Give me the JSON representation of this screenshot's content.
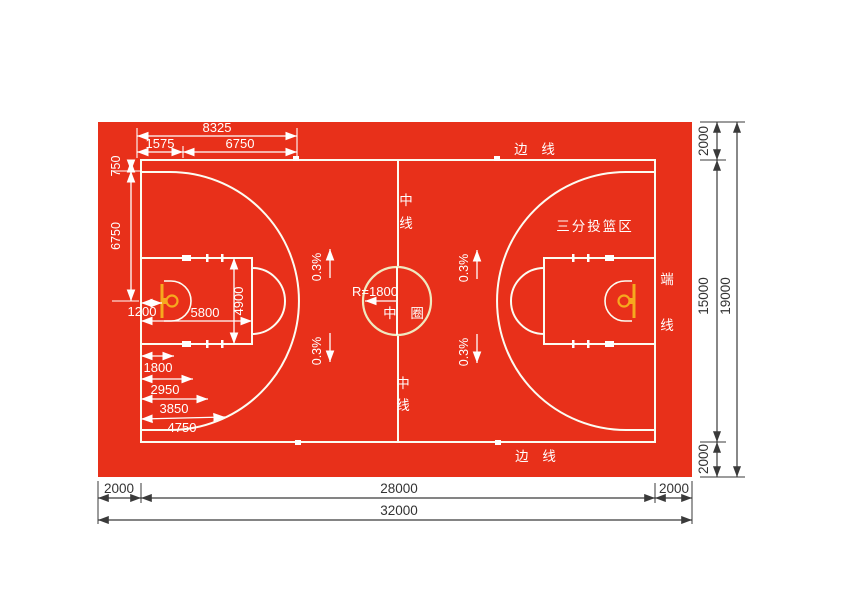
{
  "title": "basketball-court-construction-plan",
  "colors": {
    "red": "#e8301a",
    "green": "#1ba43c",
    "court_line": "#fcfcf2",
    "circle_ring": "#efe9c0",
    "basket_orange": "#f6a91e",
    "dim_dark": "#3a3a3a",
    "dim_white": "#ffffff",
    "page_bg": "#ffffff"
  },
  "court": {
    "sideline_label_top": "边 线",
    "sideline_label_bottom": "边 线",
    "endline_label_chars": [
      "端",
      "线"
    ],
    "centerline_top_chars": [
      "中",
      "线"
    ],
    "centerline_bottom_chars": [
      "中",
      "线"
    ],
    "center_circle_label": "中 圈",
    "center_circle_radius_label": "R=1800",
    "three_point_zone_label": "三分投篮区",
    "slope_label": "0.3%"
  },
  "dimensions": {
    "top": {
      "total": "8325",
      "basket_offset": "1575",
      "arc_radius": "6750"
    },
    "left": {
      "corner_offset": "750",
      "half_width": "6750"
    },
    "key": {
      "backboard_offset": "1200",
      "key_length": "5800",
      "key_width": "4900"
    },
    "lane_marks": [
      "1800",
      "2950",
      "3850",
      "4750"
    ],
    "bottom": {
      "buffer_left": "2000",
      "court_length": "28000",
      "buffer_right": "2000",
      "total_length": "32000"
    },
    "right": {
      "buffer_top": "2000",
      "court_width": "15000",
      "buffer_bottom": "2000",
      "total_width": "19000"
    }
  }
}
